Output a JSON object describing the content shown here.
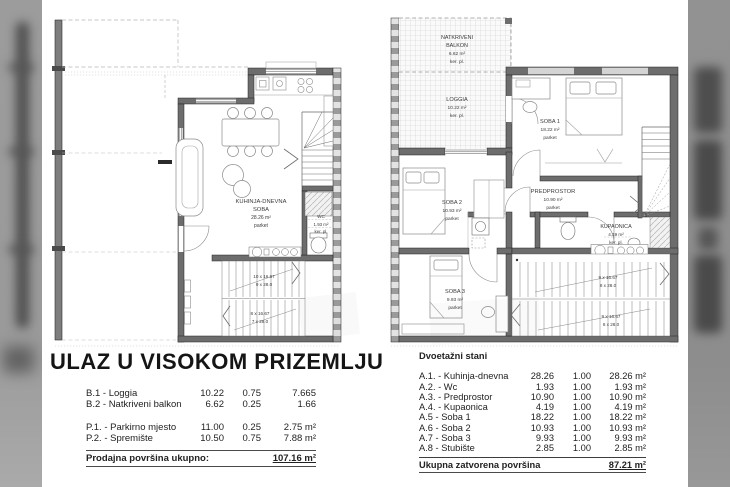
{
  "colors": {
    "wall": "#6d6d6d",
    "party_wall_dark": "#9a9a9a",
    "band_grey": "#999999",
    "band_blob": "#4e4e4e",
    "line_grey": "#888888"
  },
  "left_plan": {
    "kitchen": {
      "name1": "KUHINJA-DNEVNA",
      "name2": "SOBA",
      "area": "28.26 m²",
      "floor": "parket"
    },
    "wc": {
      "name": "WC",
      "area": "1.93 m²",
      "floor": "ker. pl."
    },
    "stairs_up": {
      "steps": "10 x 16.67",
      "rise": "9 x 28.0"
    },
    "stairs_down": {
      "steps": "8 x 16.67",
      "rise": "7 x 28.0"
    }
  },
  "right_plan": {
    "balkon": {
      "name1": "NATKRIVENI",
      "name2": "BALKON",
      "area": "6.62 m²",
      "floor": "ker. pl."
    },
    "loggia": {
      "name": "LOGGIA",
      "area": "10.22 m²",
      "floor": "ker. pl."
    },
    "soba1": {
      "name": "SOBA 1",
      "area": "18.22 m²",
      "floor": "parket"
    },
    "predprostor": {
      "name": "PREDPROSTOR",
      "area": "10.90 m²",
      "floor": "parket"
    },
    "soba2": {
      "name": "SOBA 2",
      "area": "10.93 m²",
      "floor": "parket"
    },
    "kupaonica": {
      "name": "KUPAONICA",
      "area": "4.19 m²",
      "floor": "ker. pl."
    },
    "soba3": {
      "name": "SOBA 3",
      "area": "9.93 m²",
      "floor": "parket"
    },
    "stairs_up": {
      "steps": "9 x 16.67",
      "rise": "8 x 28.0"
    },
    "stairs_down": {
      "steps": "9 x 16.67",
      "rise": "8 x 28.0"
    }
  },
  "left_section": {
    "title": "ULAZ U VISOKOM PRIZEMLJU",
    "rows": [
      {
        "label": "B.1 - Loggia",
        "area": "10.22",
        "coef": "0.75",
        "value": "7.665"
      },
      {
        "label": "B.2 - Natkriveni balkon",
        "area": "6.62",
        "coef": "0.25",
        "value": "1.66"
      },
      {
        "label": "P.1. - Parkirno mjesto",
        "area": "11.00",
        "coef": "0.25",
        "value": "2.75 m²"
      },
      {
        "label": "P.2. - Spremište",
        "area": "10.50",
        "coef": "0.75",
        "value": "7.88 m²"
      }
    ],
    "total_label": "Prodajna površina ukupno:",
    "total_value": "107.16 m²"
  },
  "right_section": {
    "header": "Dvoetažni stani",
    "rows": [
      {
        "label": "A.1. - Kuhinja-dnevna",
        "area": "28.26",
        "coef": "1.00",
        "value": "28.26 m²"
      },
      {
        "label": "A.2. - Wc",
        "area": "1.93",
        "coef": "1.00",
        "value": "1.93 m²"
      },
      {
        "label": "A.3. - Predprostor",
        "area": "10.90",
        "coef": "1.00",
        "value": "10.90 m²"
      },
      {
        "label": "A.4. - Kupaonica",
        "area": "4.19",
        "coef": "1.00",
        "value": "4.19 m²"
      },
      {
        "label": "A.5 - Soba 1",
        "area": "18.22",
        "coef": "1.00",
        "value": "18.22 m²"
      },
      {
        "label": "A.6 - Soba 2",
        "area": "10.93",
        "coef": "1.00",
        "value": "10.93 m²"
      },
      {
        "label": "A.7 - Soba 3",
        "area": "9.93",
        "coef": "1.00",
        "value": "9.93 m²"
      },
      {
        "label": "A.8 - Stubište",
        "area": "2.85",
        "coef": "1.00",
        "value": "2.85 m²"
      }
    ],
    "total_label": "Ukupna zatvorena površina",
    "total_value": "87.21 m²"
  }
}
